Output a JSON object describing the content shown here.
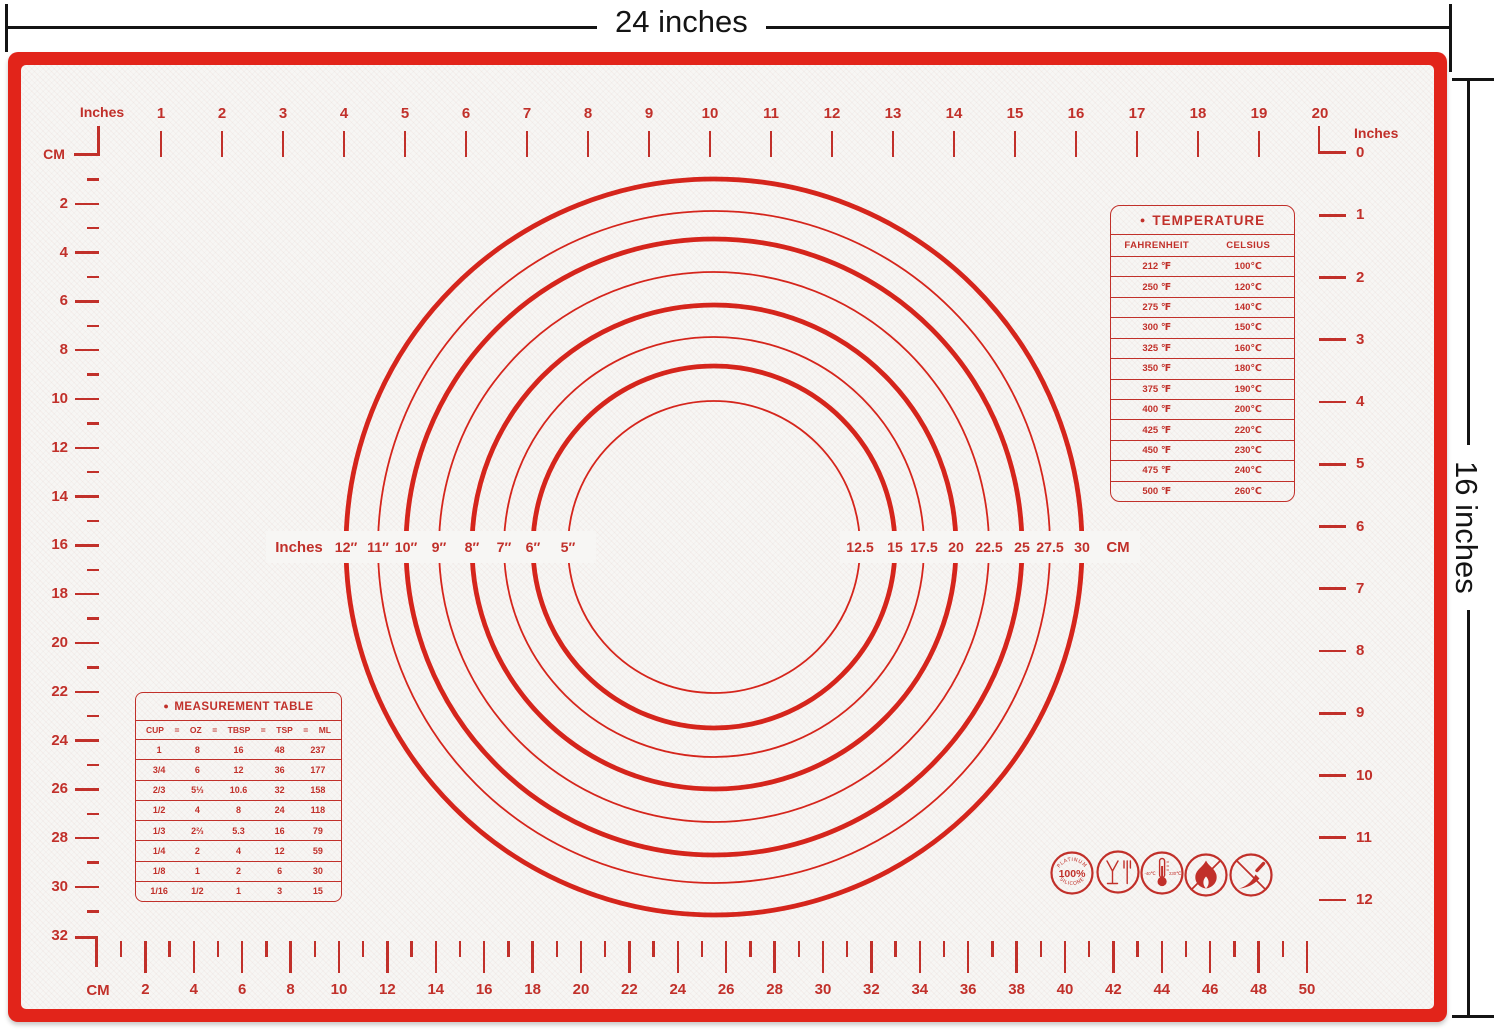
{
  "product": {
    "width_dimension_label": "24 inches",
    "height_dimension_label": "16 inches"
  },
  "colors": {
    "border_red": "#e2241a",
    "marking_red": "#c1302a",
    "circle_red": "#d5251c",
    "mat_bg": "#f7f6f4",
    "dimension_black": "#141414"
  },
  "rulers": {
    "top": {
      "unit_label": "Inches",
      "numbers": [
        1,
        2,
        3,
        4,
        5,
        6,
        7,
        8,
        9,
        10,
        11,
        12,
        13,
        14,
        15,
        16,
        17,
        18,
        19,
        20
      ]
    },
    "right": {
      "unit_label": "Inches",
      "numbers": [
        0,
        1,
        2,
        3,
        4,
        5,
        6,
        7,
        8,
        9,
        10,
        11,
        12
      ]
    },
    "left": {
      "unit_label": "CM",
      "numbers": [
        2,
        4,
        6,
        8,
        10,
        12,
        14,
        16,
        18,
        20,
        22,
        24,
        26,
        28,
        30,
        32
      ]
    },
    "bottom": {
      "unit_label": "CM",
      "numbers": [
        2,
        4,
        6,
        8,
        10,
        12,
        14,
        16,
        18,
        20,
        22,
        24,
        26,
        28,
        30,
        32,
        34,
        36,
        38,
        40,
        42,
        44,
        46,
        48,
        50
      ]
    }
  },
  "circle_guide": {
    "left_unit_label": "Inches",
    "right_unit_label": "CM",
    "rings": [
      {
        "inches": "5″",
        "cm": "12.5"
      },
      {
        "inches": "6″",
        "cm": "15"
      },
      {
        "inches": "7″",
        "cm": "17.5"
      },
      {
        "inches": "8″",
        "cm": "20"
      },
      {
        "inches": "9″",
        "cm": "22.5"
      },
      {
        "inches": "10″",
        "cm": "25"
      },
      {
        "inches": "11″",
        "cm": "27.5"
      },
      {
        "inches": "12″",
        "cm": "30"
      }
    ]
  },
  "temperature_table": {
    "title": "TEMPERATURE",
    "columns": [
      "FAHRENHEIT",
      "CELSIUS"
    ],
    "rows": [
      [
        "212 ℉",
        "100℃"
      ],
      [
        "250 ℉",
        "120℃"
      ],
      [
        "275 ℉",
        "140℃"
      ],
      [
        "300 ℉",
        "150℃"
      ],
      [
        "325 ℉",
        "160℃"
      ],
      [
        "350 ℉",
        "180℃"
      ],
      [
        "375 ℉",
        "190℃"
      ],
      [
        "400 ℉",
        "200℃"
      ],
      [
        "425 ℉",
        "220℃"
      ],
      [
        "450 ℉",
        "230℃"
      ],
      [
        "475 ℉",
        "240℃"
      ],
      [
        "500 ℉",
        "260℃"
      ]
    ]
  },
  "measurement_table": {
    "title": "MEASUREMENT TABLE",
    "columns": [
      "CUP",
      "OZ",
      "TBSP",
      "TSP",
      "ML"
    ],
    "rows": [
      [
        "1",
        "8",
        "16",
        "48",
        "237"
      ],
      [
        "3/4",
        "6",
        "12",
        "36",
        "177"
      ],
      [
        "2/3",
        "5⅓",
        "10.6",
        "32",
        "158"
      ],
      [
        "1/2",
        "4",
        "8",
        "24",
        "118"
      ],
      [
        "1/3",
        "2⅔",
        "5.3",
        "16",
        "79"
      ],
      [
        "1/4",
        "2",
        "4",
        "12",
        "59"
      ],
      [
        "1/8",
        "1",
        "2",
        "6",
        "30"
      ],
      [
        "1/16",
        "1/2",
        "1",
        "3",
        "15"
      ]
    ]
  },
  "icons": {
    "badge": {
      "percent": "100%",
      "arc_top": "PLATINUM",
      "arc_bottom": "SILICONE"
    },
    "thermometer": {
      "min": "-40℃",
      "max": "230℃"
    }
  }
}
